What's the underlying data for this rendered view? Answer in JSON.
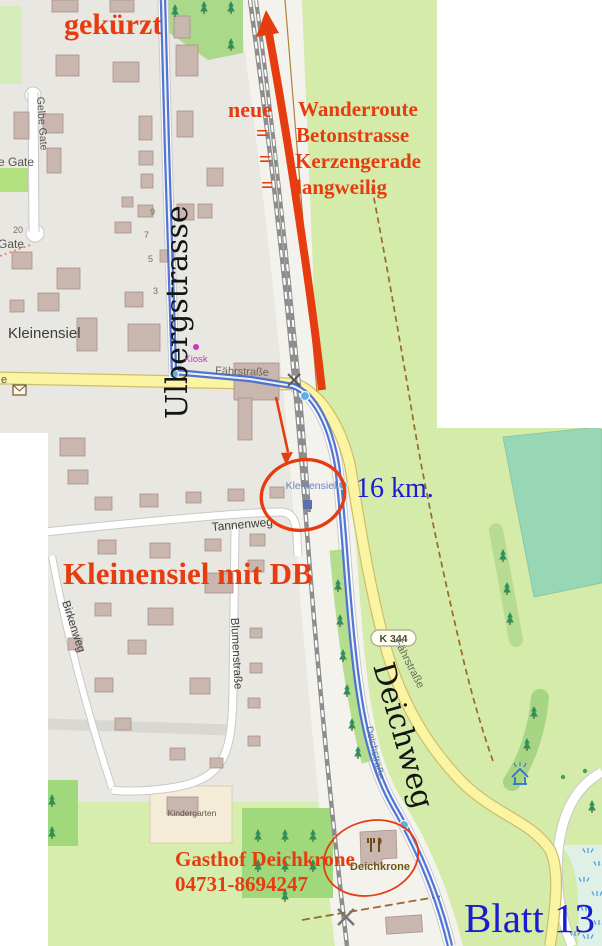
{
  "colors": {
    "annotation_red": "#e63c10",
    "annotation_blue": "#1b1bd0",
    "route_blue": "#4a6fd0",
    "road_yellow": "#fbf4a3",
    "urban_gray": "#e9e7e1",
    "field_green": "#d6edae",
    "building_fill": "#c9b6ae"
  },
  "annotations": {
    "shortened": "gekürzt",
    "neue": "neue",
    "equals": "=",
    "route_desc": [
      "Wanderroute",
      "Betonstrasse",
      "Kerzengerade",
      "langweilig"
    ],
    "distance": "16 km.",
    "title": "Kleinensiel mit DB",
    "gasthof_name": "Gasthof Deichkrone",
    "gasthof_phone": "04731-8694247",
    "sheet": "Blatt 13"
  },
  "map": {
    "place": "Kleinensiel",
    "station": "Kleinensiel",
    "road_ref": "K 344",
    "streets": {
      "ulbergstrasse": "Ulbergstrasse",
      "gelbe_gate": "Gelbe Gate",
      "gelbe_gate_cut": "e Gate",
      "gate": "Gate",
      "street_cut_e": "e",
      "faehrstrasse": "Fährstraße",
      "tannenweg": "Tannenweg",
      "birkenweg": "Birkenweg",
      "blumenstrasse": "Blumenstraße",
      "deichweg": "Deichweg",
      "deichstrasse": "Deichstraße"
    },
    "house_numbers": {
      "h20": "20",
      "h9": "9",
      "h7": "7",
      "h5": "5",
      "h3": "3"
    },
    "pois": {
      "kiosk": "Kiosk",
      "kindergarten": "Kindergarten",
      "restaurant": "Deichkrone"
    }
  }
}
